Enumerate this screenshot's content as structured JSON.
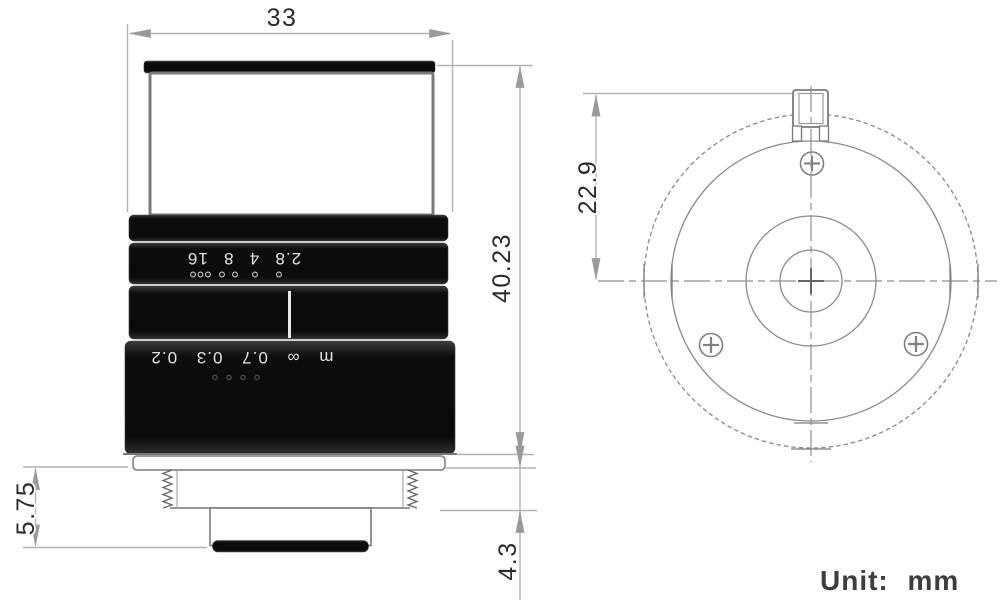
{
  "drawing": {
    "unit_label": "Unit: mm",
    "dimensions": {
      "body_width": "33",
      "body_height": "40.23",
      "rear_length": "5.75",
      "thread_length": "4.3",
      "mount_height": "22.9"
    },
    "side_view": {
      "aperture_scale": "2.8 4 8 16",
      "focus_scale": "m ∞ 0.7 0.3 0.2"
    }
  }
}
